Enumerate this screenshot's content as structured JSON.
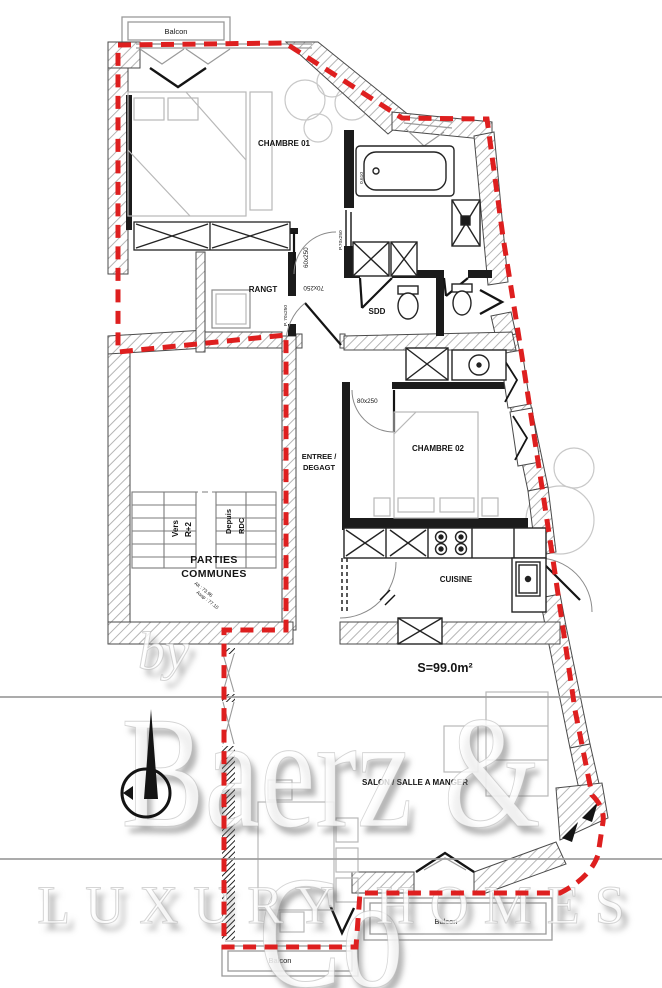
{
  "colors": {
    "boundary_red": "#de1f1f",
    "surface_red": "#e02324",
    "wall_dark": "#1b1b1b",
    "hatch_gray": "#a8a8a8",
    "furniture_gray": "#b8b8b8",
    "watermark_gray": "#9c9c9c"
  },
  "plan": {
    "rooms": {
      "balcon_top": "Balcon",
      "chambre01": "CHAMBRE 01",
      "rangt": "RANGT",
      "sdd": "SDD",
      "entree1": "ENTREE /",
      "entree2": "DEGAGT",
      "chambre02": "CHAMBRE 02",
      "parties1": "PARTIES",
      "parties2": "COMMUNES",
      "cuisine": "CUISINE",
      "salon": "SALON / SALLE A MANGER",
      "balcon_bottom_left": "Balcon",
      "balcon_bottom_right": "Balcon"
    },
    "stairs": {
      "up1": "Vers",
      "up2": "R+2",
      "down1": "Depuis",
      "down2": "RDC"
    },
    "levels": {
      "alt": "Alt : 73.96",
      "assp": "Assp : 77.10"
    },
    "doors": {
      "chambre01": "60x250",
      "entry": "70x250",
      "chambre02": "80x250",
      "rangt": "P. 70x250",
      "bath": "P.70x250",
      "tub": "0.610"
    },
    "surface": "S=99.0m²"
  },
  "watermark": {
    "by": "by",
    "brand": "Baerz & Co",
    "tagline": "LUXURY HOMES"
  }
}
